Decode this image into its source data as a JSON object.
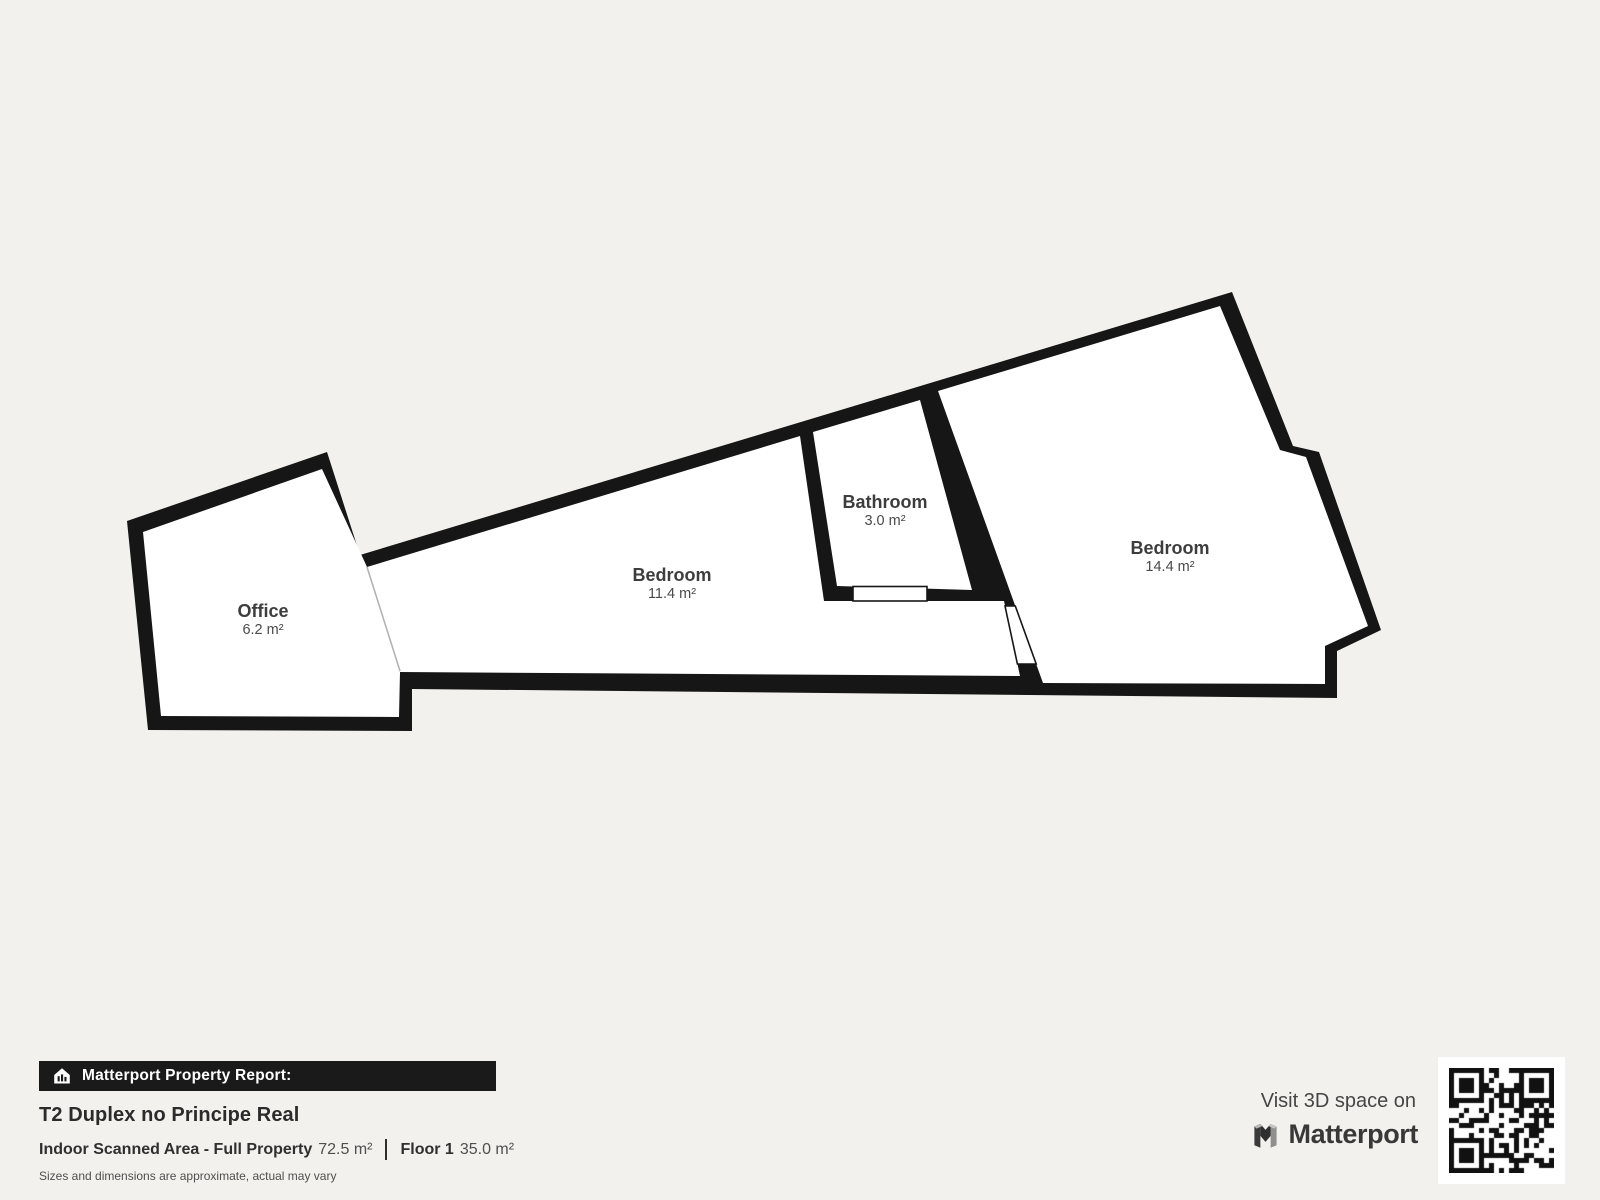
{
  "floor_plan": {
    "rooms": [
      {
        "name": "Office",
        "area": "6.2 m²"
      },
      {
        "name": "Bedroom",
        "area": "11.4 m²"
      },
      {
        "name": "Bathroom",
        "area": "3.0 m²"
      },
      {
        "name": "Bedroom",
        "area": "14.4 m²"
      }
    ]
  },
  "report": {
    "badge_icon": "house-chart-icon",
    "badge_label": "Matterport Property Report:",
    "title": "T2 Duplex no Principe Real",
    "scanned_area_label": "Indoor Scanned Area - Full Property",
    "scanned_area_value": "72.5 m²",
    "floor_label": "Floor 1",
    "floor_value": "35.0 m²",
    "disclaimer": "Sizes and dimensions are approximate, actual may vary"
  },
  "cta": {
    "visit_text": "Visit 3D space on",
    "brand": "Matterport",
    "logo_icon": "matterport-m-icon",
    "qr_icon": "qr-code"
  },
  "colors": {
    "background": "#f2f1ee",
    "wall": "#161616",
    "room_fill": "#ffffff",
    "room_name_text": "#3d3d3d",
    "room_area_text": "#4a4a4a",
    "badge_bar_bg": "#1a1a1a",
    "badge_bar_text": "#ffffff",
    "title_text": "#2b2b2b",
    "open_boundary_line": "#b3b3b3"
  }
}
